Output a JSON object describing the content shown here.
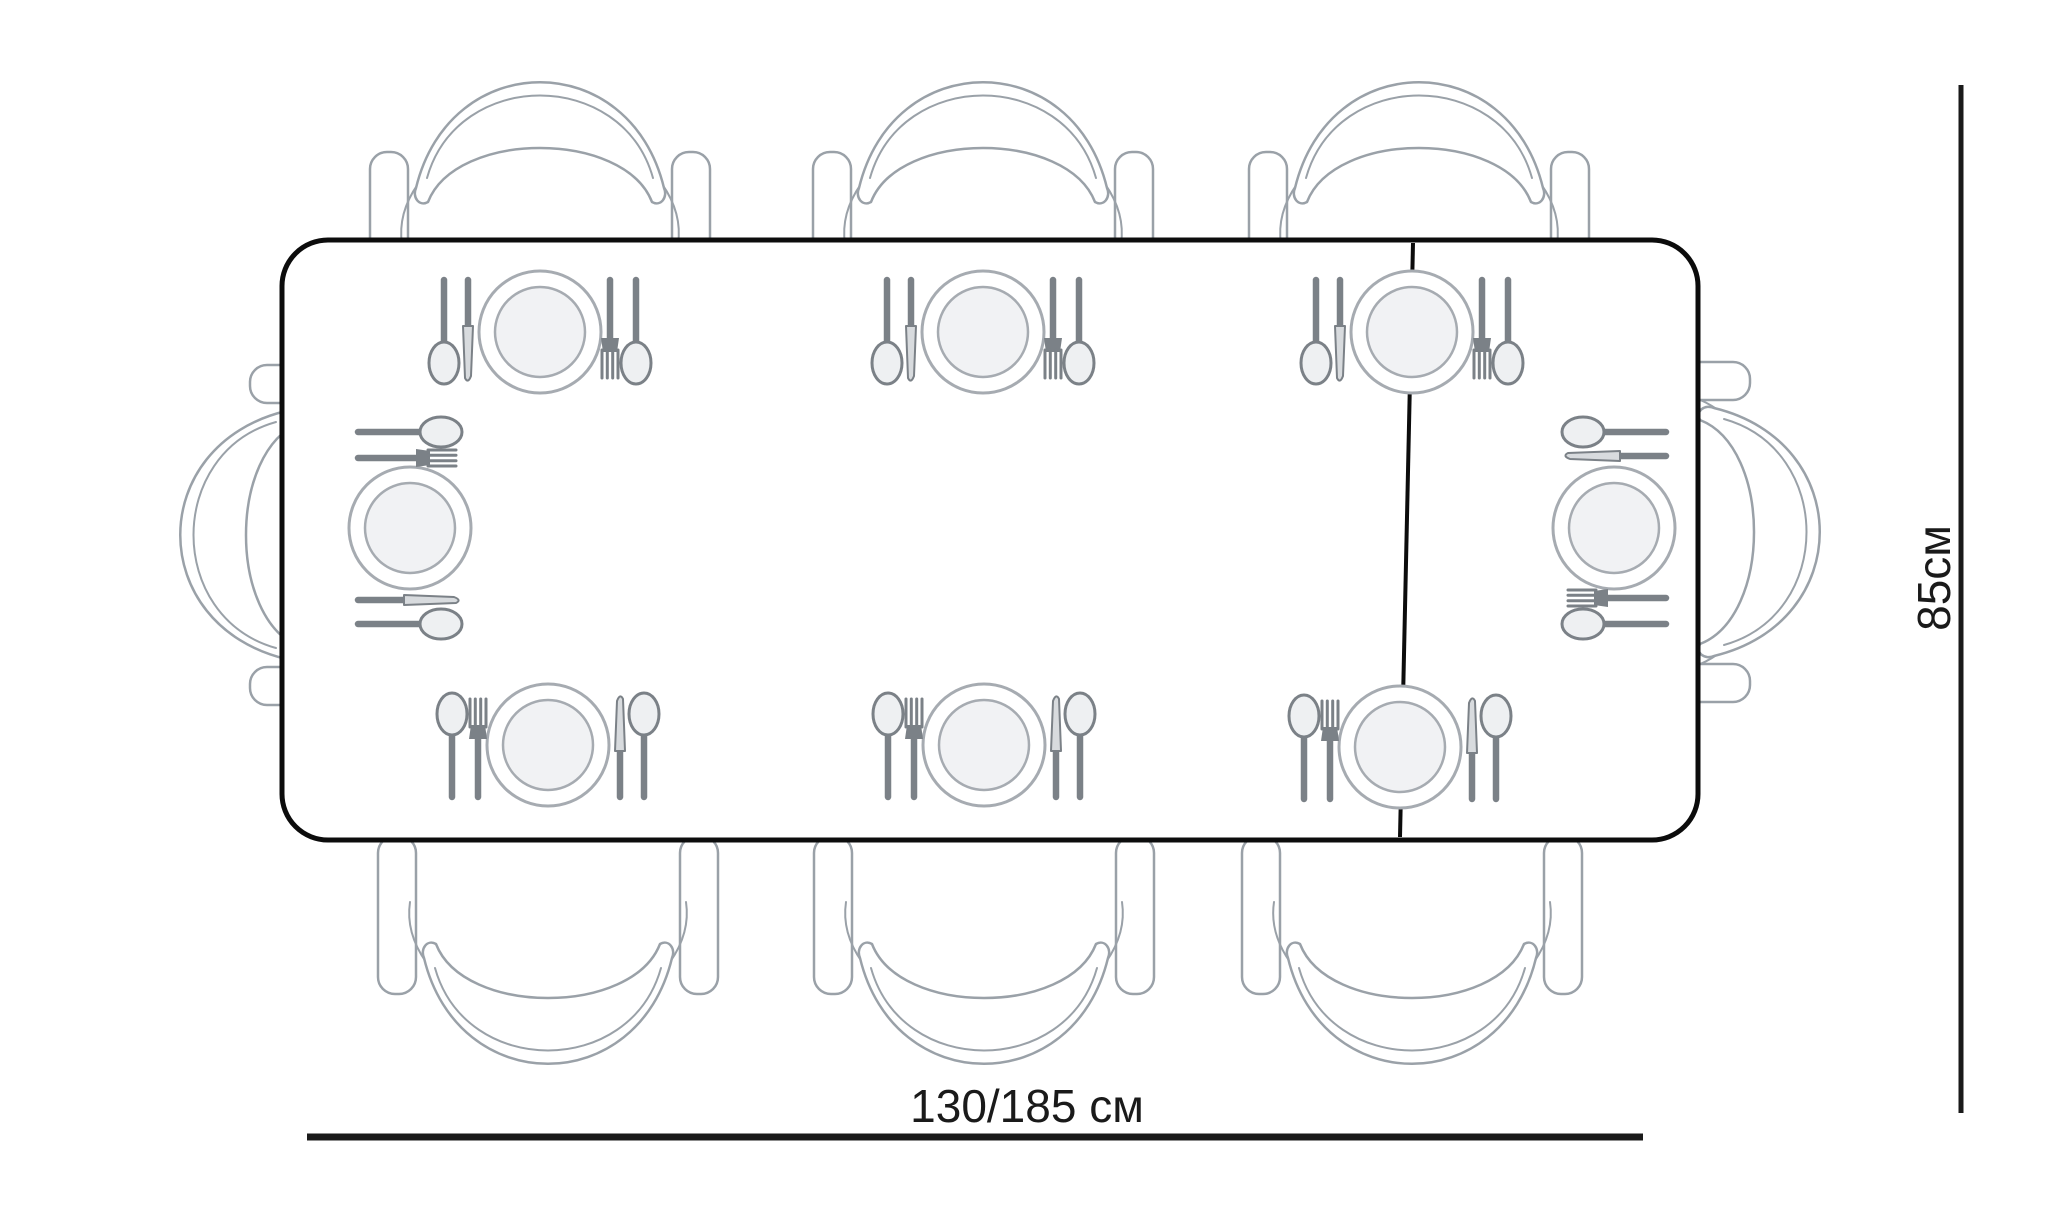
{
  "diagram": {
    "type": "dining-table-top-view-dimension-drawing",
    "seat_count": 8,
    "place_setting_count": 8,
    "colors": {
      "background": "#ffffff",
      "table_border": "#0c0c0c",
      "chair_line": "#9aa1a8",
      "cutlery": "#7b8187",
      "plate_ring": "#a6abb1",
      "plate_fill": "#f1f2f4",
      "dimension": "#1a1a1a"
    },
    "table": {
      "x": 282,
      "y": 240,
      "width": 1416,
      "height": 600,
      "corner_radius": 46,
      "border_width": 5
    },
    "extension_leaf_line": {
      "x1": 1413,
      "y1": 243,
      "x2": 1400,
      "y2": 837
    },
    "chairs": [
      {
        "side": "top-left",
        "x": 540,
        "y": 240,
        "angle": 0
      },
      {
        "side": "top-center",
        "x": 983,
        "y": 240,
        "angle": 0
      },
      {
        "side": "top-right",
        "x": 1419,
        "y": 240,
        "angle": 0
      },
      {
        "side": "bottom-left",
        "x": 548,
        "y": 906,
        "angle": 180
      },
      {
        "side": "bottom-center",
        "x": 984,
        "y": 906,
        "angle": 180
      },
      {
        "side": "bottom-right",
        "x": 1412,
        "y": 906,
        "angle": 180
      },
      {
        "side": "left-end",
        "x": 338,
        "y": 535,
        "angle": -90
      },
      {
        "side": "right-end",
        "x": 1662,
        "y": 532,
        "angle": 90
      }
    ],
    "place_settings": [
      {
        "side": "top-left",
        "x": 540,
        "y": 332,
        "angle": 0
      },
      {
        "side": "top-center",
        "x": 983,
        "y": 332,
        "angle": 0
      },
      {
        "side": "top-right",
        "x": 1412,
        "y": 332,
        "angle": 0
      },
      {
        "side": "bottom-left",
        "x": 548,
        "y": 745,
        "angle": 180
      },
      {
        "side": "bottom-center",
        "x": 984,
        "y": 745,
        "angle": 180
      },
      {
        "side": "bottom-right",
        "x": 1400,
        "y": 747,
        "angle": 180
      },
      {
        "side": "left-end",
        "x": 410,
        "y": 528,
        "angle": -90
      },
      {
        "side": "right-end",
        "x": 1614,
        "y": 528,
        "angle": 90
      }
    ],
    "dimension_width": {
      "label": "130/185 см",
      "line": {
        "x1": 307,
        "y1": 1137,
        "x2": 1643,
        "y2": 1137
      },
      "text_x": 1027,
      "text_y": 1122
    },
    "dimension_depth": {
      "label": "85см",
      "line": {
        "x1": 1961,
        "y1": 85,
        "x2": 1961,
        "y2": 1113
      },
      "text_x": 1934,
      "text_y": 578,
      "rotation": -90
    }
  }
}
